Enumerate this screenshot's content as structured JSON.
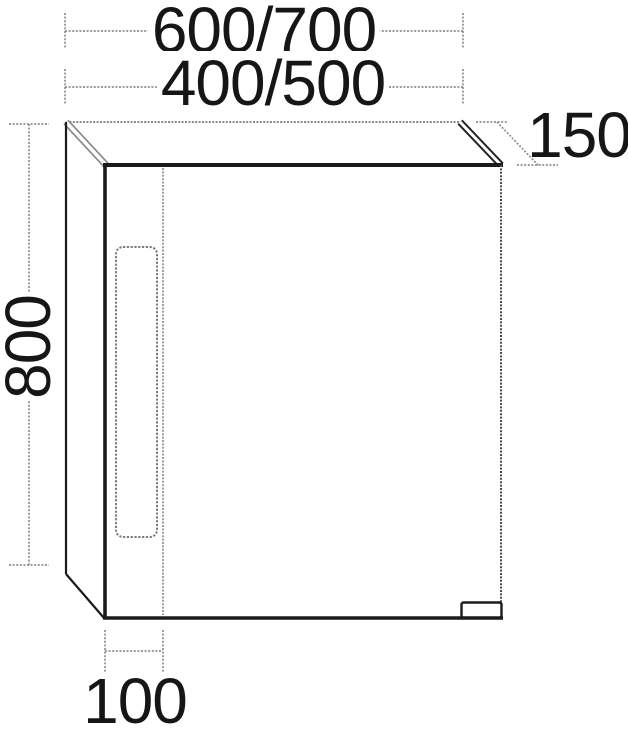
{
  "figure": {
    "kind": "technical-drawing"
  },
  "colors": {
    "background": "#ffffff",
    "edge_dark": "#1b1b1b",
    "edge_mid": "#4a4a4a",
    "line_gray": "#8e8e8e",
    "text": "#161616"
  },
  "dimensions": {
    "width_options_large": "600/700",
    "width_options_small": "400/500",
    "height": "800",
    "depth": "150",
    "detail_width": "100"
  }
}
